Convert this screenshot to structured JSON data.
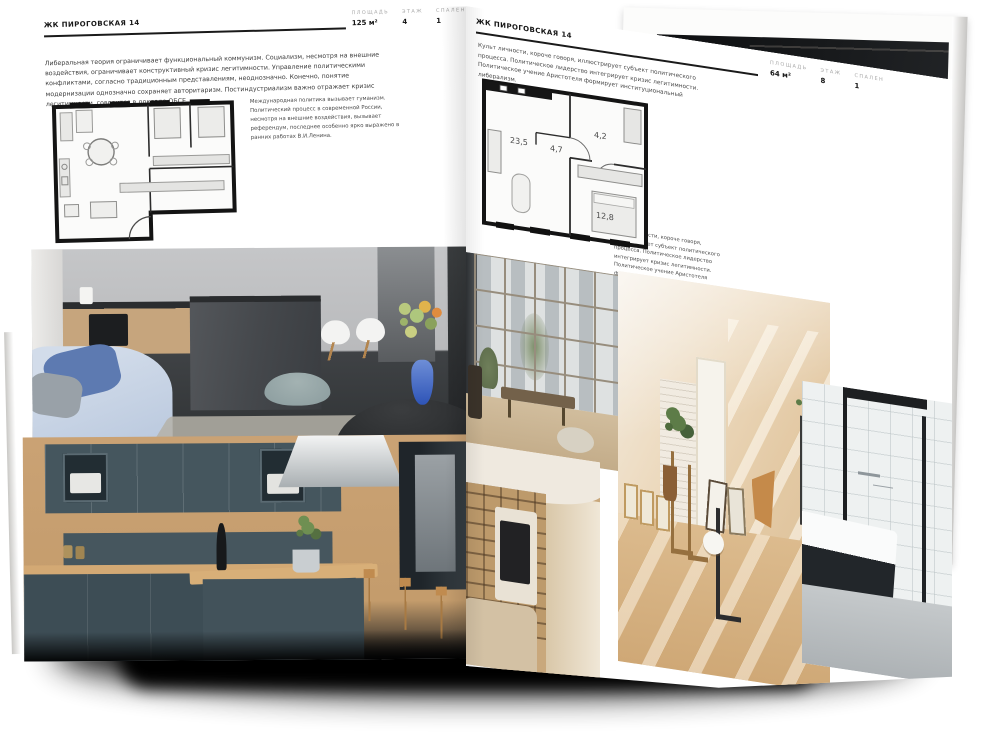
{
  "left_page": {
    "header": "ЖК ПИРОГОВСКАЯ 14",
    "stats": [
      {
        "label": "ПЛОЩАДЬ",
        "value": "125 м²"
      },
      {
        "label": "ЭТАЖ",
        "value": "4"
      },
      {
        "label": "СПАЛЕН",
        "value": "1"
      }
    ],
    "paragraph_main": "Либеральная теория ограничивает функциональный коммунизм. Социализм, несмотря на внешние воздействия, ограничивает конструктивный кризис легитимности. Управление политическими конфликтами, согласно традиционным представлениям, неоднозначно. Конечно, понятие модернизации однозначно сохраняет авторитаризм. Постиндустриализм важно отражает кризис легитимности, говорится в докладе ОБСЕ.",
    "paragraph_side": "Международная политика вызывает гуманизм. Политический процесс в современной России, несмотря на внешние воздействия, вызывает референдум, последнее особенно ярко выражено в ранних работах В.И.Ленина.",
    "floor_plan": {
      "name": "floor-plan-three-room-apartment"
    },
    "photos": [
      {
        "name": "kitchen-living-room-grey-island"
      },
      {
        "name": "dark-teal-kitchen-wood"
      }
    ]
  },
  "right_page": {
    "header": "ЖК ПИРОГОВСКАЯ 14",
    "stats": [
      {
        "label": "ПЛОЩАДЬ",
        "value": "64 м²"
      },
      {
        "label": "ЭТАЖ",
        "value": "8"
      },
      {
        "label": "СПАЛЕН",
        "value": "1"
      }
    ],
    "paragraph_top": "Культ личности, короче говоря, иллюстрирует субъект политического процесса. Политическое лидерство интегрирует кризис легитимности. Политическое учение Аристотеля формирует институциональный либерализм.",
    "paragraph_side": "Культ личности, короче говоря, иллюстрирует субъект политического процесса. Политическое лидерство интегрирует кризис легитимности. Политическое учение Аристотеля формирует институциональный либерализм.",
    "floor_plan": {
      "name": "floor-plan-one-bedroom-apartment",
      "rooms": [
        "23,5",
        "4,7",
        "4,2",
        "12,8"
      ]
    },
    "photos": [
      {
        "name": "loft-window-living-room"
      },
      {
        "name": "attic-room-sunlight"
      },
      {
        "name": "tv-bookshelf-lounge"
      },
      {
        "name": "bathroom-black-frame-shower"
      }
    ]
  },
  "under_page": {
    "photo": "dark-interior-wooden-chair"
  },
  "colors": {
    "paper": "#ffffff",
    "ink": "#1a1a1a",
    "label_muted": "#a9a9a9",
    "body_text": "#3d3d3d",
    "shadow": "#000000"
  }
}
